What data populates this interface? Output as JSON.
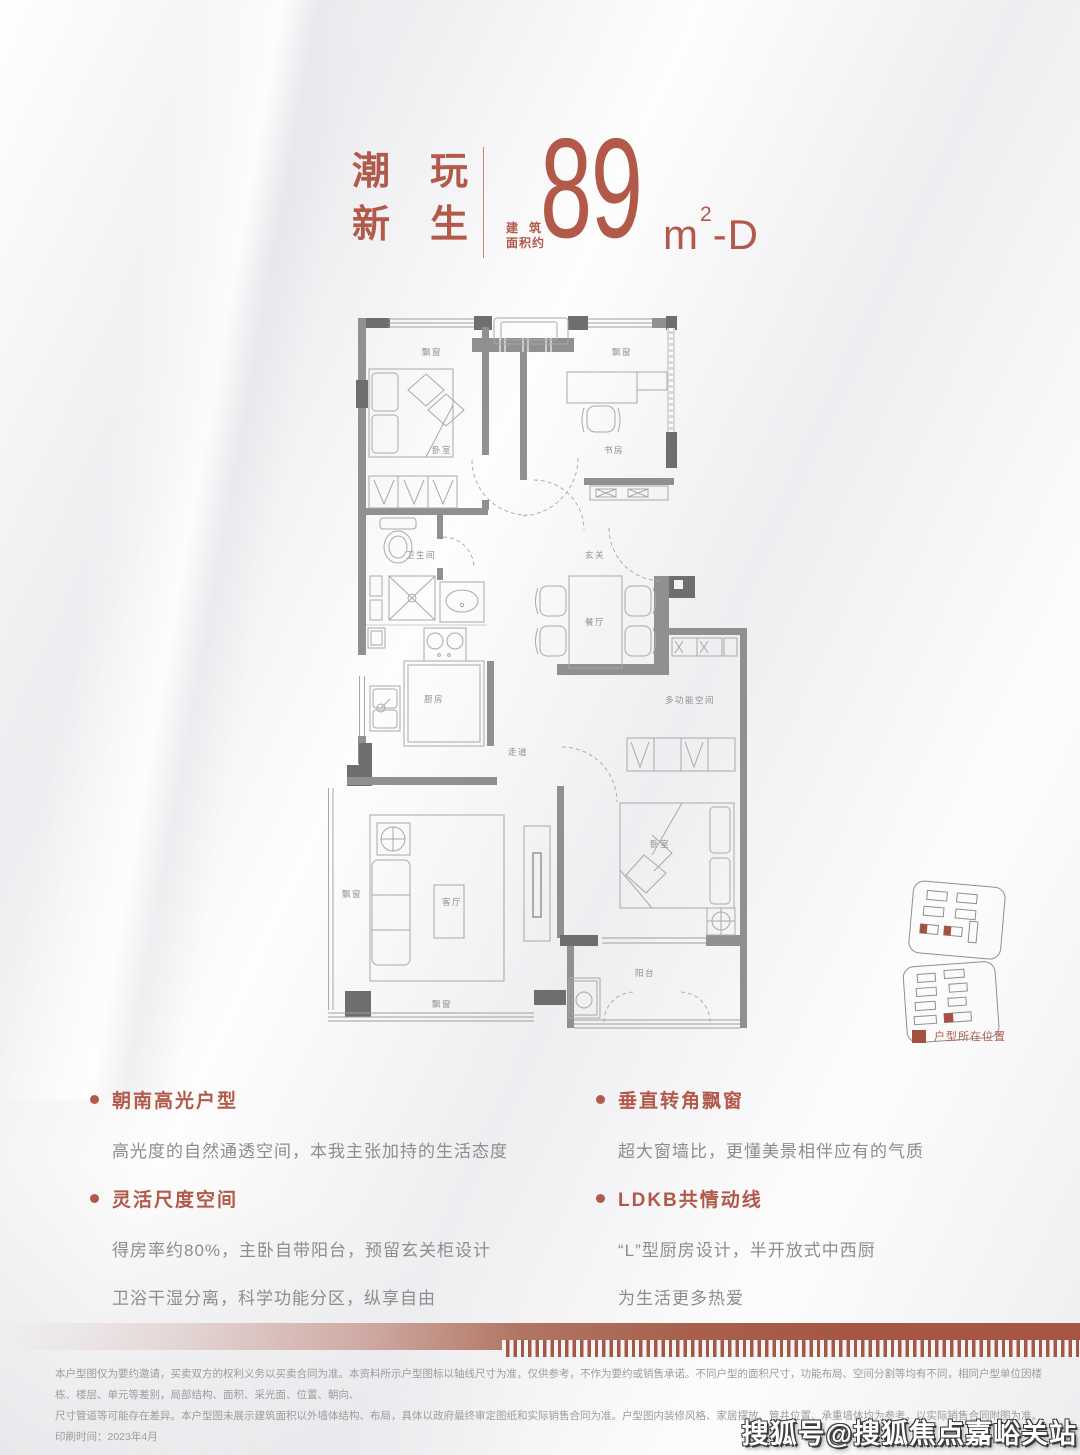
{
  "accent_color": "#b2594a",
  "red_color": "#a6513f",
  "header": {
    "title_line1": "潮玩",
    "title_line2": "新生",
    "area_prefix_line1": "建筑",
    "area_prefix_line2": "面积约",
    "area_number": "89",
    "area_unit_m": "m",
    "area_unit_sup": "2",
    "area_unit_suffix": "-D"
  },
  "floorplan": {
    "rooms": {
      "bay_window": "飘窗",
      "bedroom": "卧室",
      "study": "书房",
      "bathroom": "卫生间",
      "foyer": "玄关",
      "dining": "餐厅",
      "kitchen": "厨房",
      "corridor": "走道",
      "multi_room": "多功能空间",
      "living": "客厅",
      "master_bedroom": "卧室",
      "balcony": "阳台"
    }
  },
  "legend": {
    "label": "户型所在位置"
  },
  "features": {
    "left": [
      {
        "heading": "朝南高光户型",
        "lines": [
          "高光度的自然通透空间，本我主张加持的生活态度"
        ]
      },
      {
        "heading": "灵活尺度空间",
        "lines": [
          "得房率约80%，主卧自带阳台，预留玄关柜设计",
          "卫浴干湿分离，科学功能分区，纵享自由"
        ]
      }
    ],
    "right": [
      {
        "heading": "垂直转角飘窗",
        "lines": [
          "超大窗墙比，更懂美景相伴应有的气质"
        ]
      },
      {
        "heading": "LDKB共情动线",
        "lines": [
          "“L”型厨房设计，半开放式中西厨",
          "为生活更多热爱"
        ]
      }
    ]
  },
  "disclaimer": {
    "line1": "本户型图仅为要约邀请，买卖双方的权利义务以买卖合同为准。本资料所示户型图标以轴线尺寸为准，仅供参考，不作为要约或销售承诺。不同户型的面积尺寸，功能布局、空间分割等均有不同，相同户型单位因楼栋、楼层、单元等差别，局部结构、面积、采光面、位置、朝向、",
    "line2": "尺寸管道等可能存在差异。本户型图未展示建筑面积以外墙体结构、布局，具体以政府最终审定图纸和实际销售合同为准。户型图内装修风格、家居摆放、管井位置、承重墙体均为参考，以实际销售合同附图为准。印刷时间：2023年4月"
  },
  "watermark": "搜狐号@搜狐焦点嘉峪关站"
}
